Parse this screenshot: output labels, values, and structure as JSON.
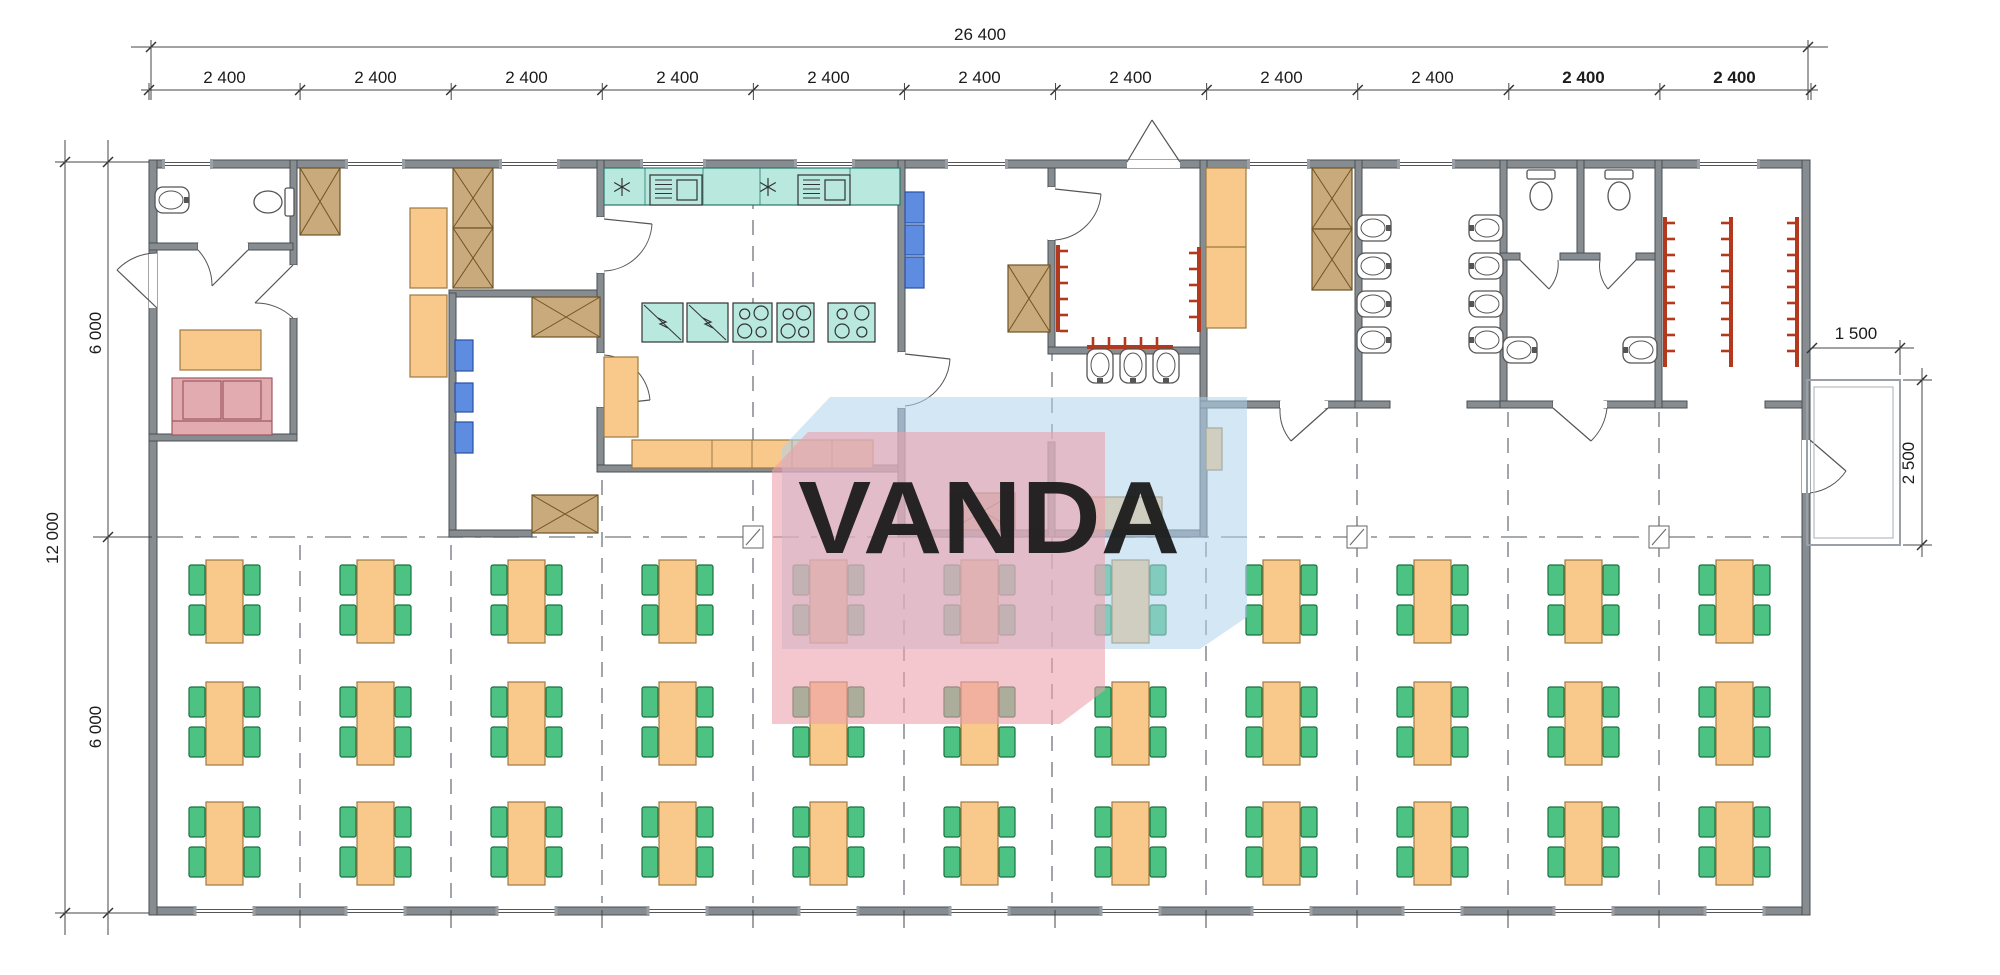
{
  "drawing": {
    "type": "canteen floor plan",
    "watermark_text": "VANDA"
  },
  "dimensions": {
    "top_total": "26 400",
    "top_modules": [
      {
        "label": "2 400",
        "bold": false
      },
      {
        "label": "2 400",
        "bold": false
      },
      {
        "label": "2 400",
        "bold": false
      },
      {
        "label": "2 400",
        "bold": false
      },
      {
        "label": "2 400",
        "bold": false
      },
      {
        "label": "2 400",
        "bold": false
      },
      {
        "label": "2 400",
        "bold": false
      },
      {
        "label": "2 400",
        "bold": false
      },
      {
        "label": "2 400",
        "bold": false
      },
      {
        "label": "2 400",
        "bold": true
      },
      {
        "label": "2 400",
        "bold": true
      }
    ],
    "left_total": "12 000",
    "left_upper": "6 000",
    "left_lower": "6 000",
    "porch_width": "1 500",
    "porch_depth": "2 500"
  },
  "dining": {
    "columns": 11,
    "rows": 3,
    "tables": 33,
    "chairs_per_table": 4
  },
  "fixtures": {
    "toilets": 3,
    "washbasins": 14,
    "kitchen_sinks": 2,
    "stoves": 3,
    "prep_tables": 2,
    "fridges": 3,
    "blue_lockers": 6,
    "wardrobes": 8,
    "coat_racks": 6,
    "sofas": 1
  },
  "colors": {
    "wall": "#878c91",
    "wall_edge": "#4a4f54",
    "furniture_orange": "#f9c88b",
    "furniture_orange_edge": "#9c7a42",
    "chair_green": "#4cc383",
    "chair_green_edge": "#17713f",
    "kitchen_teal": "#b9e8df",
    "kitchen_teal_edge": "#27776b",
    "locker_blue": "#5d8ce0",
    "locker_blue_edge": "#2b4fa0",
    "wardrobe_brown": "#c9aa7c",
    "wardrobe_brown_edge": "#6e5426",
    "sofa_pink": "#e2abb0",
    "sofa_pink_edge": "#9c5a60",
    "rack_red": "#b2391e",
    "ribbon_blue": "#aed3ec",
    "ribbon_pink": "#eda0ac",
    "watermark_text_color": "#ffffff",
    "dashed_line": "#8a8f94",
    "dimension_line": "#444444"
  }
}
